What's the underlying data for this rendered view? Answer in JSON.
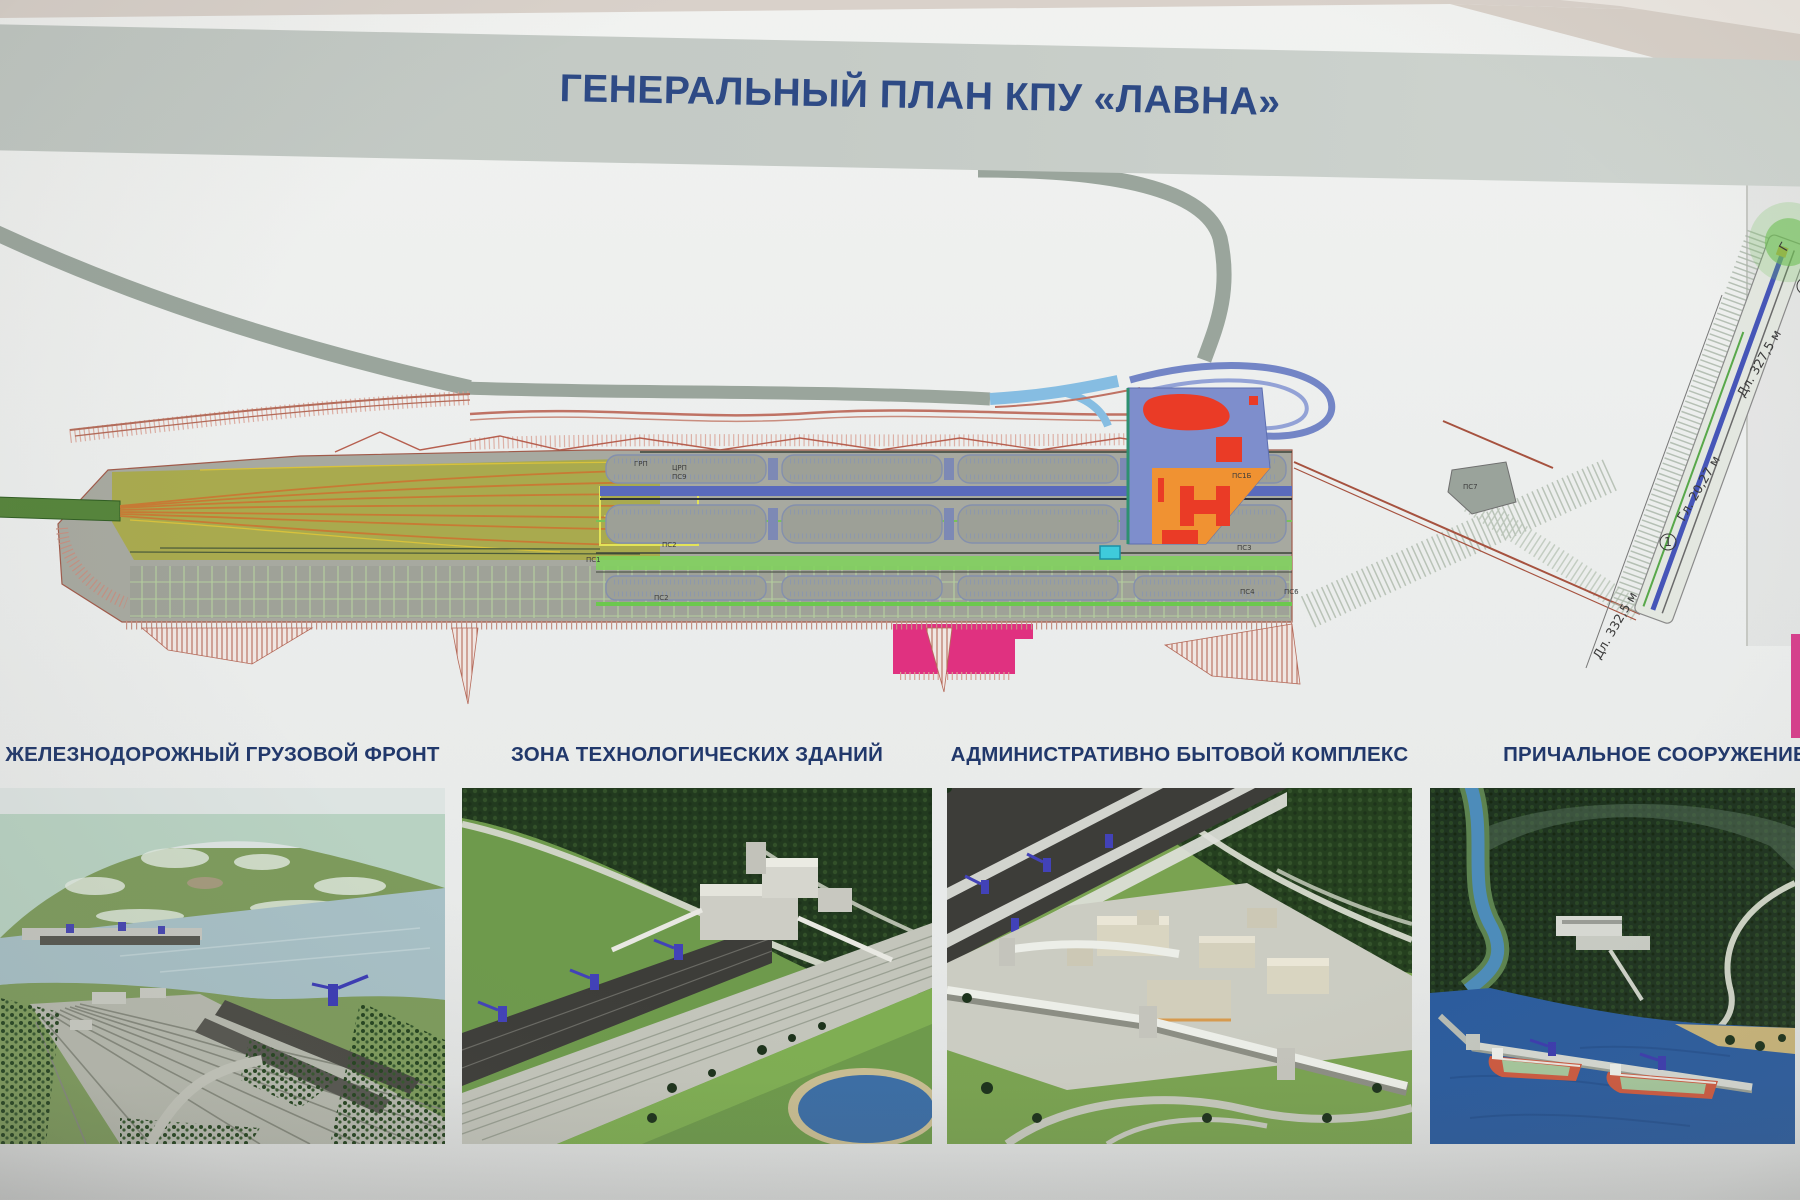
{
  "poster": {
    "title": "ГЕНЕРАЛЬНЫЙ ПЛАН КПУ «ЛАВНА»"
  },
  "plan": {
    "small_labels": [
      {
        "text": "ГРП"
      },
      {
        "text": "ЦРП"
      },
      {
        "text": "ПС9"
      },
      {
        "text": "ПС1"
      },
      {
        "text": "ПС2"
      },
      {
        "text": "ПС2"
      },
      {
        "text": "ПС1Б"
      },
      {
        "text": "ПС3"
      },
      {
        "text": "ПС4"
      },
      {
        "text": "ПС6"
      },
      {
        "text": "ПС7"
      }
    ],
    "pier_labels": [
      {
        "text": "Дл. 332,5 м"
      },
      {
        "text": "1"
      },
      {
        "text": "Гл. 20,27 м"
      },
      {
        "text": "Дл. 327,5 м"
      },
      {
        "text": "2"
      },
      {
        "text": "Г"
      }
    ]
  },
  "sections": [
    {
      "caption": "ЖЕЛЕЗНОДОРОЖНЫЙ ГРУЗОВОЙ ФРОНТ"
    },
    {
      "caption": "ЗОНА ТЕХНОЛОГИЧЕСКИХ ЗДАНИЙ"
    },
    {
      "caption": "АДМИНИСТРАТИВНО БЫТОВОЙ КОМПЛЕКС"
    },
    {
      "caption": "ПРИЧАЛЬНОЕ СООРУЖЕНИЕ"
    }
  ],
  "colors": {
    "title_text": "#2e4a85",
    "title_band": "#c5cbc6",
    "caption_text": "#21386b",
    "plan_platform": "#a7a9a0",
    "plan_rail_yard": "#a9aa4e",
    "plan_tracks_orange": "#c87a34",
    "plan_conveyor_blue": "#5a6abc",
    "plan_conveyor_green": "#7fd45a",
    "plan_abk_blue": "#7e8ecc",
    "plan_abk_orange": "#f09232",
    "plan_buildings_red": "#ea3b26",
    "plan_magenta": "#e03180",
    "plan_cyan": "#3fcbdb",
    "plan_road_gray": "#9aa59c",
    "plan_road_lightblue": "#86bde2",
    "plan_rail_salmon": "#bf7264",
    "pier_glow_green": "#6fc255",
    "wall_taupe": "#d9d1ca",
    "ship_hull_red": "#cd5a40",
    "ship_hatch_green": "#a6c79c",
    "water_deep_blue": "#2b5c9e",
    "forest_dark": "#223a1f"
  }
}
